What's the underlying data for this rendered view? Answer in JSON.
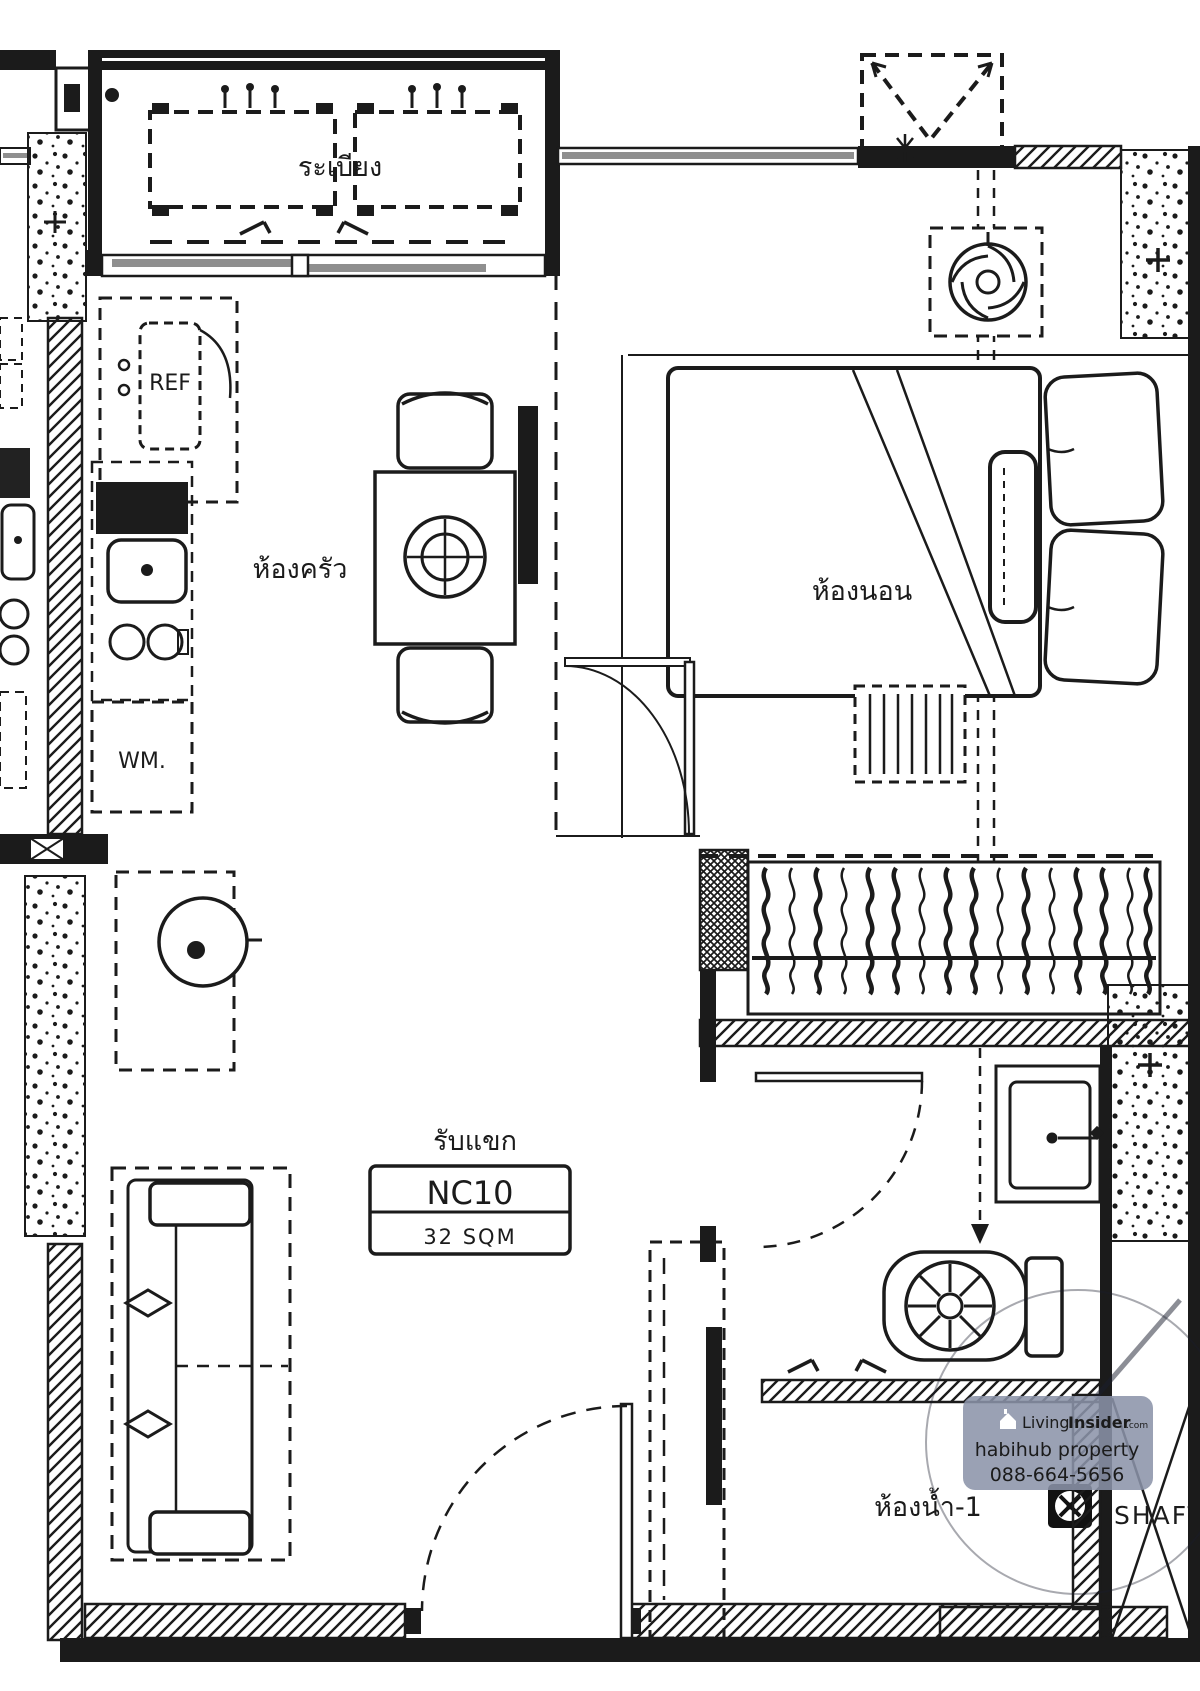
{
  "unit": {
    "code": "NC10",
    "area": "32 SQM"
  },
  "rooms": {
    "balcony": {
      "label": "ระเบียง"
    },
    "kitchen": {
      "label": "ห้องครัว"
    },
    "bedroom": {
      "label": "ห้องนอน"
    },
    "living": {
      "label": "รับแขก"
    },
    "bathroom": {
      "label": "ห้องน้ำ-1"
    },
    "shaft": {
      "label": "SHAFT"
    }
  },
  "appliances": {
    "refrigerator": "REF",
    "washing_machine": "WM."
  },
  "watermark": {
    "brand_first": "Living",
    "brand_second": "Insider",
    "brand_tld": ".com",
    "agency": "habihub property",
    "phone": "088-664-5656"
  },
  "colors": {
    "ink": "#1b1b1b",
    "paper": "#ffffff",
    "glass": "#8f8f8f",
    "badge": "#8b93a9"
  }
}
